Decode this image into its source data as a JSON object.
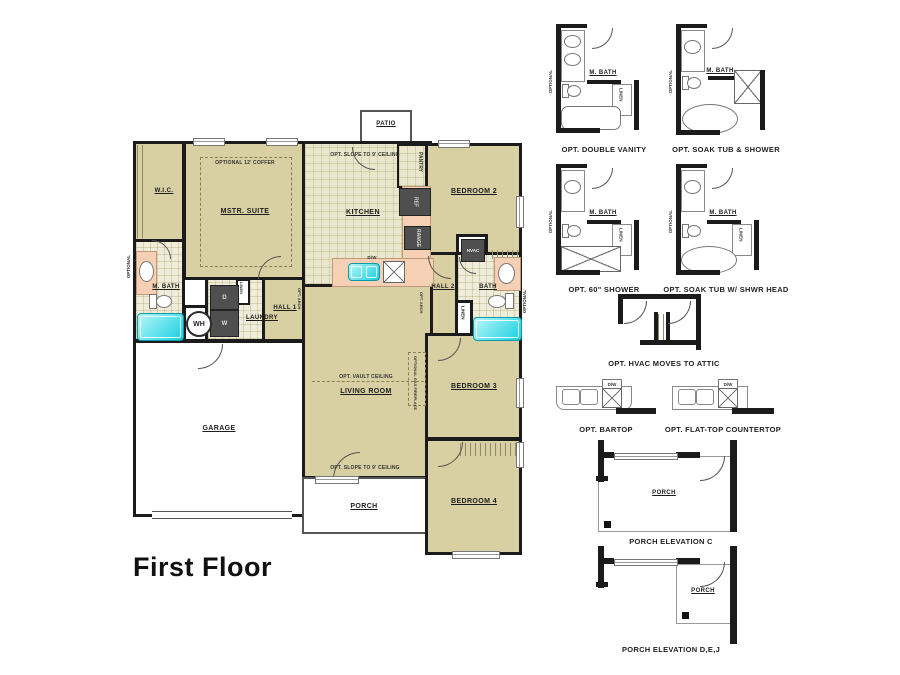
{
  "plan": {
    "title": "First Floor",
    "patio": "PATIO",
    "wic": "W.I.C.",
    "mstr_suite": "MSTR. SUITE",
    "coffer_note": "OPTIONAL 12' COFFER",
    "kitchen": "KITCHEN",
    "slope_note_kitchen": "OPT. SLOPE TO 9' CEILING",
    "pantry": "PANTRY",
    "ref": "REF",
    "range": "RANGE",
    "dw": "D/W",
    "bedroom2": "BEDROOM 2",
    "hvac": "HVAC",
    "hall2": "HALL 2",
    "bath": "BATH",
    "linen": "LINEN",
    "optional": "OPTIONAL",
    "m_bath": "M. BATH",
    "wh": "WH",
    "washer": "W",
    "dryer": "D",
    "laundry": "LAUNDRY",
    "hall1": "HALL 1",
    "opt_arch": "OPT. ARCH",
    "living_room": "LIVING ROOM",
    "vault_note": "OPT. VAULT CEILING",
    "fireplace_note": "OPTIONAL GAS FIREPLACE",
    "slope_note_living": "OPT. SLOPE TO 9' CEILING",
    "garage": "GARAGE",
    "porch": "PORCH",
    "bedroom3": "BEDROOM 3",
    "bedroom4": "BEDROOM 4"
  },
  "options": {
    "double_vanity": {
      "caption": "OPT. DOUBLE VANITY",
      "room": "M. BATH",
      "linen": "LINEN",
      "optional": "OPTIONAL"
    },
    "soak_tub_shower": {
      "caption": "OPT. SOAK TUB & SHOWER",
      "room": "M. BATH",
      "optional": "OPTIONAL"
    },
    "shower_60": {
      "caption": "OPT. 60\" SHOWER",
      "room": "M. BATH",
      "linen": "LINEN",
      "optional": "OPTIONAL"
    },
    "soak_tub_shwr_head": {
      "caption": "OPT. SOAK TUB W/ SHWR HEAD",
      "room": "M. BATH",
      "linen": "LINEN",
      "optional": "OPTIONAL"
    },
    "hvac_attic": {
      "caption": "OPT. HVAC MOVES TO ATTIC"
    },
    "bartop": {
      "caption": "OPT. BARTOP",
      "dw": "D/W"
    },
    "flat_top_countertop": {
      "caption": "OPT. FLAT-TOP COUNTERTOP",
      "dw": "D/W"
    },
    "porch_elevation_c": {
      "caption": "PORCH ELEVATION C",
      "room": "PORCH"
    },
    "porch_elevation_dej": {
      "caption": "PORCH ELEVATION D,E,J",
      "room": "PORCH"
    }
  },
  "colors": {
    "wall": "#1b1b1b",
    "room_fill": "#d8cfa2",
    "tile_fill": "#efecd9",
    "kitchen_fill": "#eae6cb",
    "counter_fill": "#f6d0b4",
    "fixture_cyan": "#2adce6",
    "appliance_gray": "#4f4f4f"
  }
}
